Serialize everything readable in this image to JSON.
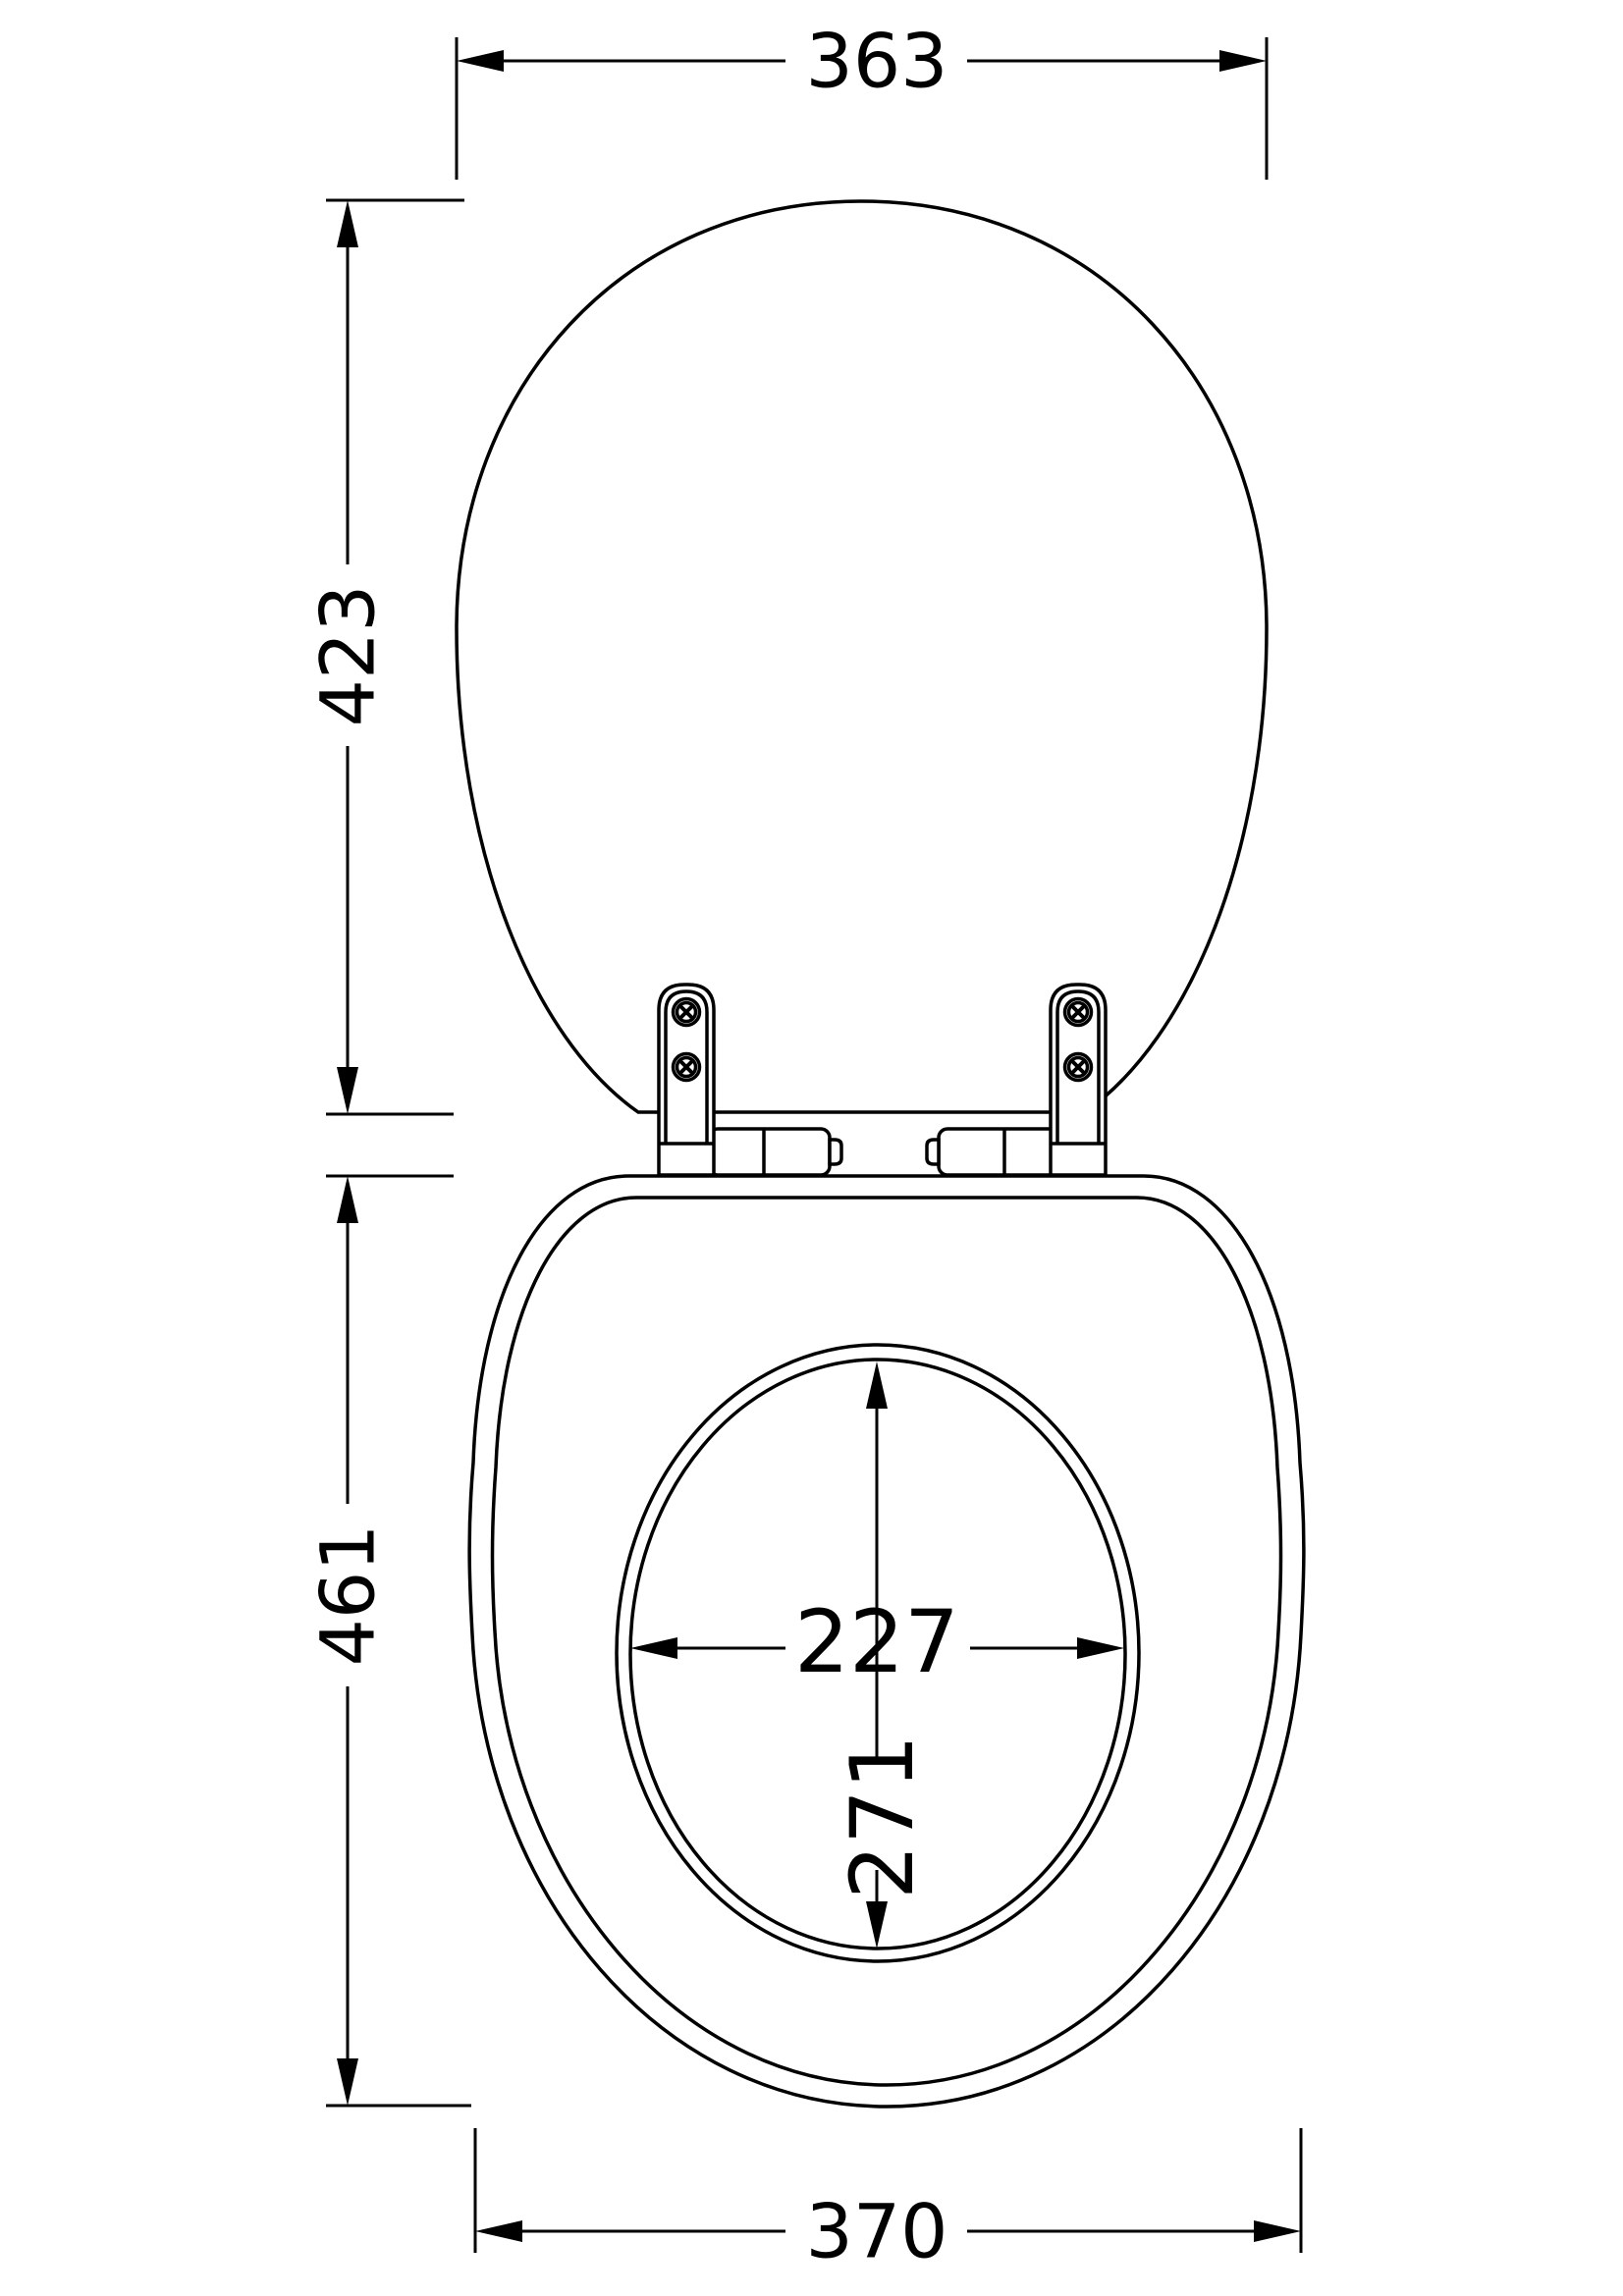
{
  "drawing": {
    "background": "#ffffff",
    "line_color": "#000000",
    "labels": {
      "lid_width": "363",
      "lid_height": "423",
      "seat_length": "461",
      "seat_width": "370",
      "opening_width": "227",
      "opening_length": "271"
    }
  }
}
